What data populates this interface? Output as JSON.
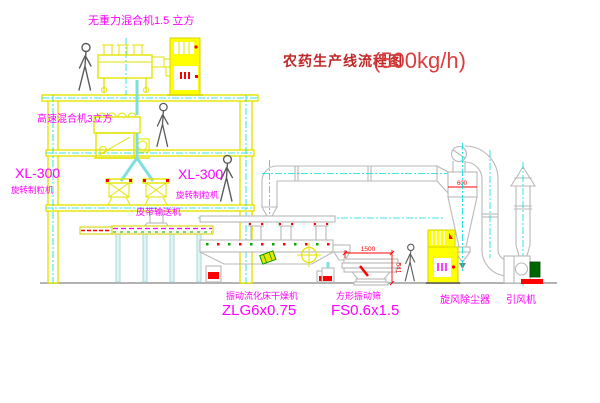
{
  "title": {
    "name": "农药生产线流程图",
    "capacity": "(500kg/h)"
  },
  "equipment_labels": {
    "gravity_mixer": "无重力混合机1.5 立方",
    "high_speed_mixer": "高速混合机3立方",
    "granulator_left_model": "XL-300",
    "granulator_left_name": "旋转制粒机",
    "granulator_right_model": "XL-300",
    "granulator_right_name": "旋转制粒机",
    "belt_conveyor": "皮带输送机",
    "dryer_name": "振动流化床干燥机",
    "dryer_model": "ZLG6x0.75",
    "sieve_name": "方形振动筛",
    "sieve_model": "FS0.6x1.5",
    "cyclone": "旋风除尘器",
    "fan": "引风机"
  },
  "dimensions": {
    "sieve_length": "1500",
    "sieve_height": "541",
    "cyclone_dia": "600"
  },
  "colors": {
    "building_yellow": "#e3e300",
    "cabinet_yellow": "#ffff00",
    "equipment_gray": "#b9b9b9",
    "centerline_cyan": "#00dede",
    "label_magenta": "#ff00ff",
    "dimension_red": "#ff0000",
    "title_dark_red": "#c02828",
    "motor_green": "#006600"
  }
}
